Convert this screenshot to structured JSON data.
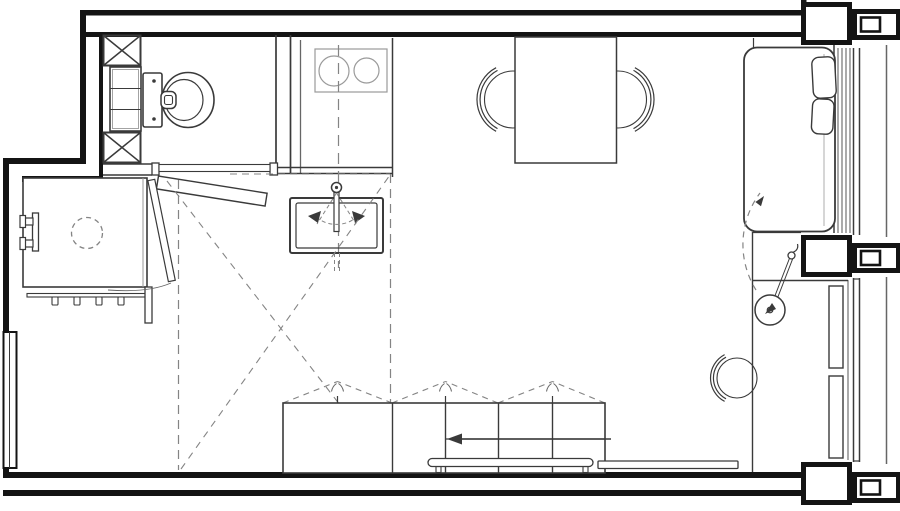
{
  "title": "Studio apartment floor plan - furniture layout drawing",
  "canvas": {
    "width": 900,
    "height": 511,
    "background": "#ffffff"
  },
  "colors": {
    "background": "#ffffff",
    "wall": "#141414",
    "ink": "#3a3a3a",
    "light": "#9a9a9a",
    "dashed": "#848484",
    "soft": "#666666"
  },
  "rooms": [
    {
      "id": "bathroom",
      "label": "Bathroom (top-left, toilet + shaft columns + shelving)"
    },
    {
      "id": "kitchen-nook",
      "label": "Kitchen nook (lower-left, worktop block with hook rail and stool)"
    },
    {
      "id": "hallway",
      "label": "Central hall with dashed transformation / swing zone"
    },
    {
      "id": "living-sleeping",
      "label": "Main living-sleeping space (dining table, bed, desk ledge)"
    },
    {
      "id": "window-facade",
      "label": "Right glazed facade with three structural piers and radiators"
    }
  ],
  "symbols": [
    {
      "id": "toilet",
      "label": "Wall-hung toilet with cistern"
    },
    {
      "id": "shaft-columns",
      "label": "Two X-hatched duct/shaft boxes with shelf column between"
    },
    {
      "id": "bathroom-door",
      "label": "Bathroom swing door leaf with threshold"
    },
    {
      "id": "nook-door",
      "label": "Narrow pivot door leaf to kitchen nook with swing arc"
    },
    {
      "id": "cooktop",
      "label": "Two-burner cooktop on counter",
      "burners": 2
    },
    {
      "id": "sink",
      "label": "Kitchen sink with swivel faucet and motion arrows"
    },
    {
      "id": "dining-table",
      "label": "Rectangular dining table"
    },
    {
      "id": "dining-chairs",
      "label": "Two round-back chairs",
      "count": 2
    },
    {
      "id": "bed",
      "label": "Double bed with two pillows toward window"
    },
    {
      "id": "swing-lamp",
      "label": "Wall-mounted swing-arm lamp"
    },
    {
      "id": "tv-swing-arc",
      "label": "Dashed rotation arc with arrow at pier"
    },
    {
      "id": "armchair",
      "label": "Round-back chair near lower window"
    },
    {
      "id": "wardrobe-row",
      "label": "Wardrobe / storage run with flap-door dashes",
      "units": 5
    },
    {
      "id": "slide-arrow",
      "label": "Left-pointing sliding direction arrow"
    },
    {
      "id": "bench-rails",
      "label": "Two low rails / benches in front of wardrobe"
    },
    {
      "id": "stool",
      "label": "Dashed round stool under kitchen block"
    },
    {
      "id": "left-window",
      "label": "Window in left wall"
    },
    {
      "id": "radiators",
      "label": "Two radiator panels at lower window",
      "count": 2
    }
  ]
}
